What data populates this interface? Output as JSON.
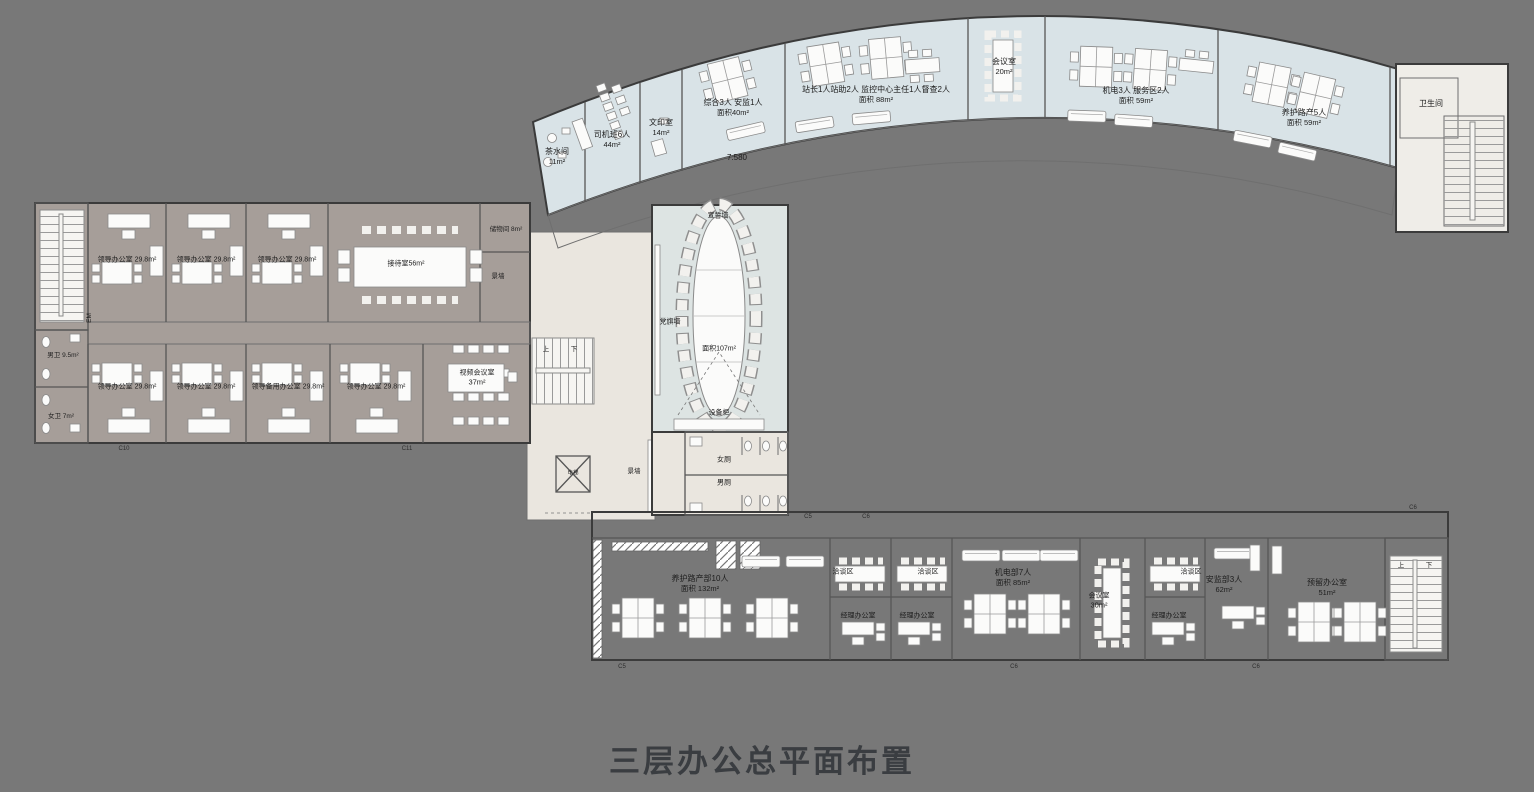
{
  "title": "三层办公总平面布置",
  "marks": {
    "level": "7.580",
    "em": "EM",
    "up": "上",
    "down": "下"
  },
  "colors": {
    "background": "#787878",
    "room_blue": "#d9e3e7",
    "room_taupe": "#a69e99",
    "corridor_beige": "#eae6df",
    "hall_blue": "#dde4e3"
  },
  "north": {
    "rooms": [
      {
        "n": "茶水间",
        "a": "11m²"
      },
      {
        "n": "司机班6人",
        "a": "44m²"
      },
      {
        "n": "文印室",
        "a": "14m²"
      },
      {
        "n": "综合3人 安监1人",
        "a": "面积40m²"
      },
      {
        "n": "站长1人站助2人  监控中心主任1人督查2人",
        "a": "面积 88m²"
      },
      {
        "n": "会议室",
        "a": "20m²"
      },
      {
        "n": "机电3人 服务区2人",
        "a": "面积 59m²"
      },
      {
        "n": "养护路产5人",
        "a": "面积 59m²"
      },
      {
        "n": "卫生间",
        "a": ""
      }
    ]
  },
  "west": {
    "top": [
      {
        "n": "领导办公室",
        "a": "29.8m²"
      },
      {
        "n": "领导办公室",
        "a": "29.8m²"
      },
      {
        "n": "领导办公室",
        "a": "29.8m²"
      },
      {
        "n": "接待室",
        "a": "56m²"
      },
      {
        "n": "储物间",
        "a": "8m²"
      }
    ],
    "bottom": [
      {
        "n": "领导办公室",
        "a": "29.8m²"
      },
      {
        "n": "领导办公室",
        "a": "29.8m²"
      },
      {
        "n": "领导备用办公室",
        "a": "29.8m²"
      },
      {
        "n": "领导办公室",
        "a": "29.8m²"
      },
      {
        "n": "视频会议室",
        "a": "37m²"
      }
    ],
    "wc_m": {
      "n": "男卫",
      "a": "9.5m²"
    },
    "wc_f": {
      "n": "女卫",
      "a": "7m²"
    },
    "scene_wall": "景墙"
  },
  "core": {
    "oath_wall": "宣誓墙",
    "flag_wall": "党旗墙",
    "area": "面积107m²",
    "cabinet": "设备柜",
    "wc_f": "女厕",
    "wc_m": "男厕",
    "scene_wall": "景墙",
    "lift": "电梯"
  },
  "south": {
    "rooms": [
      {
        "n": "养护路产部10人",
        "a": "面积 132m²"
      },
      {
        "n": "洽谈区"
      },
      {
        "n": "洽谈区"
      },
      {
        "n": "经理办公室"
      },
      {
        "n": "经理办公室"
      },
      {
        "n": "机电部7人",
        "a": "面积 85m²"
      },
      {
        "n": "会议室",
        "a": "30m²"
      },
      {
        "n": "洽谈区"
      },
      {
        "n": "经理办公室"
      },
      {
        "n": "安监部3人",
        "a": "62m²"
      },
      {
        "n": "预留办公室",
        "a": "51m²"
      }
    ]
  },
  "grid": [
    "C10",
    "C11",
    "C5",
    "C6",
    "C5",
    "C6",
    "C6",
    "C6"
  ]
}
